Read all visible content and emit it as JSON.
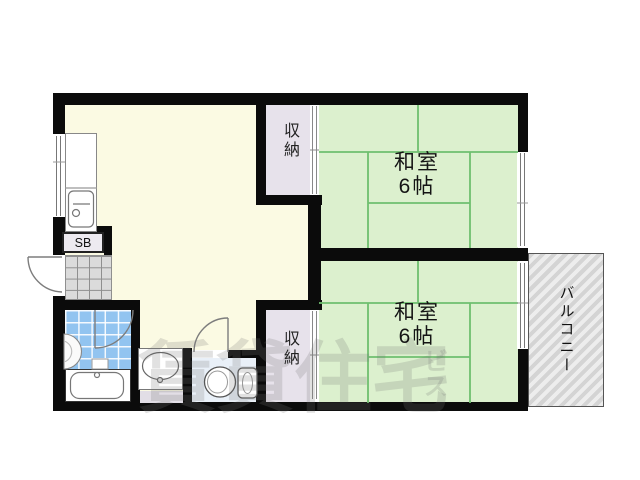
{
  "plan": {
    "rooms": {
      "japanese_room_top": {
        "name": "和室",
        "size": "6帖"
      },
      "japanese_room_bottom": {
        "name": "和室",
        "size": "6帖"
      },
      "closet_top": {
        "name": "収納"
      },
      "closet_bottom": {
        "name": "収納"
      },
      "balcony": {
        "name": "バルコニー"
      },
      "shoe_box": {
        "name": "SB"
      }
    },
    "watermark": {
      "main": "賃貸住宅",
      "side": "ビス"
    },
    "colors": {
      "wall": "#0b0b0b",
      "dk_floor": "#FBFAE3",
      "tatami": "#DCF0CE",
      "tatami_line": "#6FBF6F",
      "closet": "#E7E2EB",
      "bath_tile": "#92C4F0",
      "toilet_floor": "#E9F0F8",
      "genkan_tile": "#DBDBDB",
      "balcony_stripe": "#D4D4D4"
    }
  }
}
